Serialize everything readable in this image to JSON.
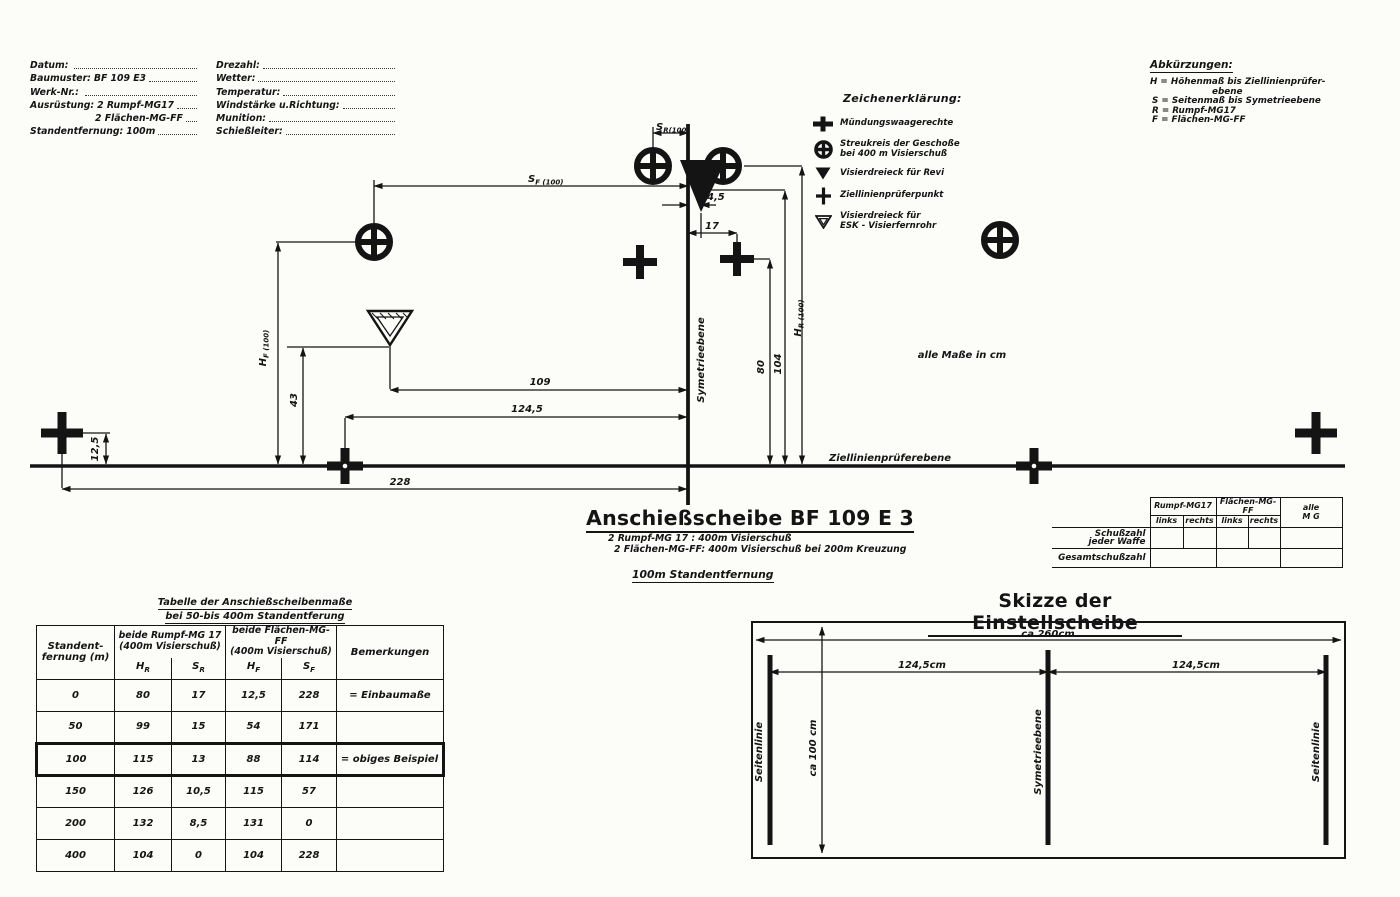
{
  "form": {
    "left": [
      {
        "label": "Datum:",
        "value": ""
      },
      {
        "label": "Baumuster:",
        "value": "BF 109 E3"
      },
      {
        "label": "Werk-Nr.:",
        "value": ""
      },
      {
        "label": "Ausrüstung:",
        "value": "2 Rumpf-MG17"
      },
      {
        "label": "",
        "value": "2 Flächen-MG-FF"
      },
      {
        "label": "Standentfernung:",
        "value": "100m"
      }
    ],
    "right": [
      {
        "label": "Drezahl:"
      },
      {
        "label": "Wetter:"
      },
      {
        "label": "Temperatur:"
      },
      {
        "label": "Windstärke u.Richtung:"
      },
      {
        "label": "Munition:"
      },
      {
        "label": "Schießleiter:"
      }
    ]
  },
  "abbreviations": {
    "title": "Abkürzungen:",
    "lines": [
      "H = Höhenmaß bis Ziellinienprüfer-",
      "ebene",
      "S = Seitenmaß bis Symetrieebene",
      "R = Rumpf-MG17",
      "F = Flächen-MG-FF"
    ]
  },
  "legend": {
    "title": "Zeichenerklärung:",
    "items": [
      {
        "line1": "Mündungswaagerechte",
        "line2": ""
      },
      {
        "line1": "Streukreis der Geschoße",
        "line2": "bei 400 m Visierschuß"
      },
      {
        "line1": "Visierdreieck für Revi",
        "line2": ""
      },
      {
        "line1": "Ziellinienprüferpunkt",
        "line2": ""
      },
      {
        "line1": "Visierdreieck für",
        "line2": "ESK - Visierfernrohr"
      }
    ]
  },
  "diagram": {
    "dims": {
      "sr": {
        "m": "S",
        "s": "R(100)"
      },
      "sf": {
        "m": "S",
        "s": "F (100)"
      },
      "hf": {
        "m": "H",
        "s": "F (100)"
      },
      "hr": {
        "m": "H",
        "s": "R (100)"
      },
      "d45": "4,5",
      "d17": "17",
      "d109": "109",
      "d1245": "124,5",
      "d228": "228",
      "d43": "43",
      "d125": "12,5",
      "d80": "80",
      "d104": "104"
    },
    "symmetry_label": "Symetrieebene",
    "sightline_label": "Ziellinienprüferebene",
    "units_note": "alle Maße in cm"
  },
  "title_block": {
    "title": "Anschießscheibe BF 109 E 3",
    "line1": "2 Rumpf-MG 17 : 400m Visierschuß",
    "line2": "2 Flächen-MG-FF: 400m Visierschuß bei 200m Kreuzung",
    "line3": "100m Standentfernung"
  },
  "shots_table": {
    "group1": "Rumpf-MG17",
    "group2": "Flächen-MG-FF",
    "group3_line1": "alle",
    "group3_line2": "M G",
    "sub1": "links",
    "sub2": "rechts",
    "sub3": "links",
    "sub4": "rechts",
    "row1_line1": "Schußzahl",
    "row1_line2": "jeder Waffe",
    "row2": "Gesamtschußzahl"
  },
  "main_table": {
    "title_line1": "Tabelle der Anschießscheibenmaße",
    "title_line2": "bei 50-bis 400m Standentferung",
    "col_distance_line1": "Standent-",
    "col_distance_line2": "fernung (m)",
    "group_rumpf_line1": "beide Rumpf-MG 17",
    "group_rumpf_line2": "(400m Visierschuß)",
    "group_flaechen_line1": "beide Flächen-MG-FF",
    "group_flaechen_line2": "(400m Visierschuß)",
    "col_notes": "Bemerkungen",
    "sub_hr": {
      "m": "H",
      "s": "R"
    },
    "sub_sr": {
      "m": "S",
      "s": "R"
    },
    "sub_hf": {
      "m": "H",
      "s": "F"
    },
    "sub_sf": {
      "m": "S",
      "s": "F"
    },
    "rows": [
      {
        "d": "0",
        "hr": "80",
        "sr": "17",
        "hf": "12,5",
        "sf": "228",
        "note": "= Einbaumaße"
      },
      {
        "d": "50",
        "hr": "99",
        "sr": "15",
        "hf": "54",
        "sf": "171",
        "note": ""
      },
      {
        "d": "100",
        "hr": "115",
        "sr": "13",
        "hf": "88",
        "sf": "114",
        "note": "= obiges Beispiel"
      },
      {
        "d": "150",
        "hr": "126",
        "sr": "10,5",
        "hf": "115",
        "sf": "57",
        "note": ""
      },
      {
        "d": "200",
        "hr": "132",
        "sr": "8,5",
        "hf": "131",
        "sf": "0",
        "note": ""
      },
      {
        "d": "400",
        "hr": "104",
        "sr": "0",
        "hf": "104",
        "sf": "228",
        "note": ""
      }
    ]
  },
  "skizze": {
    "title": "Skizze der Einstellscheibe",
    "dim_width": "ca 260cm",
    "dim_height": "ca 100 cm",
    "dim_left": "124,5cm",
    "dim_right": "124,5cm",
    "label_left": "Seitenlinie",
    "label_center": "Symetrieebene",
    "label_right": "Seitenlinie"
  }
}
